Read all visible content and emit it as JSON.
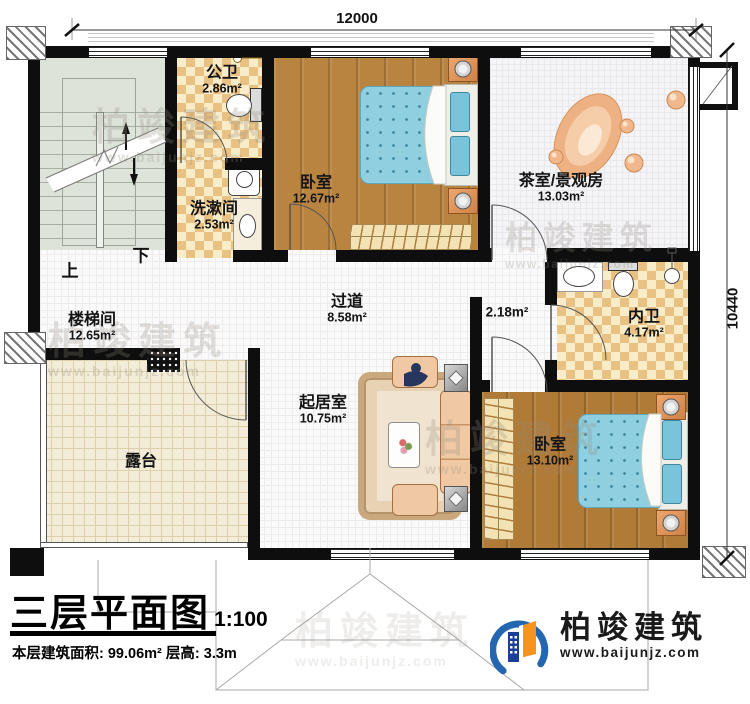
{
  "plan": {
    "title": "三层平面图",
    "scale": "1:100",
    "stats": "本层建筑面积: 99.06m²  层高: 3.3m"
  },
  "dimensions": {
    "width": "12000",
    "height": "10440"
  },
  "stairs": {
    "up": "上",
    "down": "下"
  },
  "rooms": [
    {
      "id": "stairwell",
      "name": "楼梯间",
      "area": "12.65m²"
    },
    {
      "id": "public-bathroom",
      "name": "公卫",
      "area": "2.86m²"
    },
    {
      "id": "washroom",
      "name": "洗漱间",
      "area": "2.53m²"
    },
    {
      "id": "bedroom-top",
      "name": "卧室",
      "area": "12.67m²"
    },
    {
      "id": "tea-room",
      "name": "茶室/景观房",
      "area": "13.03m²"
    },
    {
      "id": "hallway",
      "name": "过道",
      "area": "8.58m²"
    },
    {
      "id": "alcove",
      "name": "",
      "area": "2.18m²"
    },
    {
      "id": "ensuite-bathroom",
      "name": "内卫",
      "area": "4.17m²"
    },
    {
      "id": "bedroom-right",
      "name": "卧室",
      "area": "13.10m²"
    },
    {
      "id": "living-room",
      "name": "起居室",
      "area": "10.75m²"
    },
    {
      "id": "terrace",
      "name": "露台",
      "area": ""
    }
  ],
  "brand": {
    "name": "柏竣建筑",
    "website": "www.baijunjz.com"
  },
  "watermark": {
    "name": "柏竣建筑",
    "website": "www.baijunjz.com"
  },
  "colors": {
    "wall": "#0e0e0e",
    "wood_floor": "#b98440",
    "tile_light": "#f8ecc9",
    "tile_dark": "#e9c183",
    "bed_blue": "#8fcfe0",
    "brand_blue": "#2566b0",
    "brand_orange": "#f7941d"
  }
}
